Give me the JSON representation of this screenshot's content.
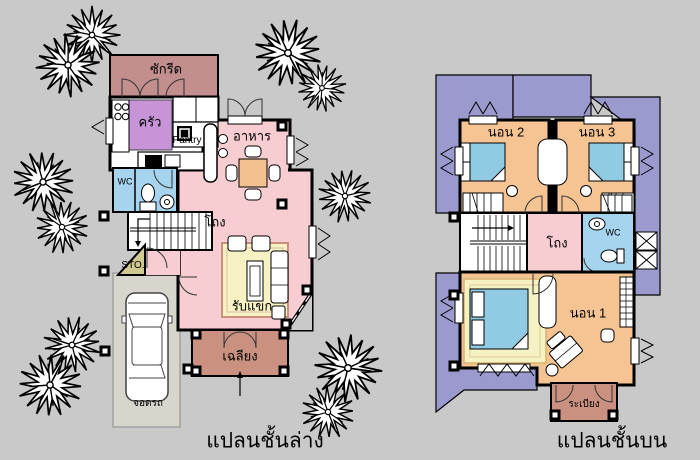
{
  "document": {
    "type": "house-floor-plan-drawing"
  },
  "colors": {
    "background": "#c9c9c9",
    "wall": "#000000",
    "laundry": "#c28e8e",
    "kitchen": "#c795d7",
    "hall_pink": "#f7cdd2",
    "wc_blue": "#a6d4ef",
    "storage_khaki": "#cfc992",
    "carport_gray": "#d8d5cc",
    "rug_cream": "#f6f2c4",
    "porch_terracotta": "#ca9181",
    "bedroom_orange": "#f6c493",
    "roof_purple": "#9b9ace",
    "bed_blue": "#90cbe3",
    "table_orange": "#f2c18f"
  },
  "ground_floor": {
    "caption": "แปลนชั้นล่าง",
    "labels": {
      "laundry": "ซักรีด",
      "kitchen": "ครัว",
      "pantry": "Pantry",
      "dining": "อาหาร",
      "wc": "WC",
      "hall": "โถง",
      "storage": "STO.",
      "living": "รับแขก",
      "porch": "เฉลียง",
      "carport": "จอดรถ"
    }
  },
  "upper_floor": {
    "caption": "แปลนชั้นบน",
    "labels": {
      "bedroom2": "นอน 2",
      "bedroom3": "นอน 3",
      "hall": "โถง",
      "wc": "WC",
      "bedroom1": "นอน 1",
      "balcony": "ระเบียง"
    }
  }
}
